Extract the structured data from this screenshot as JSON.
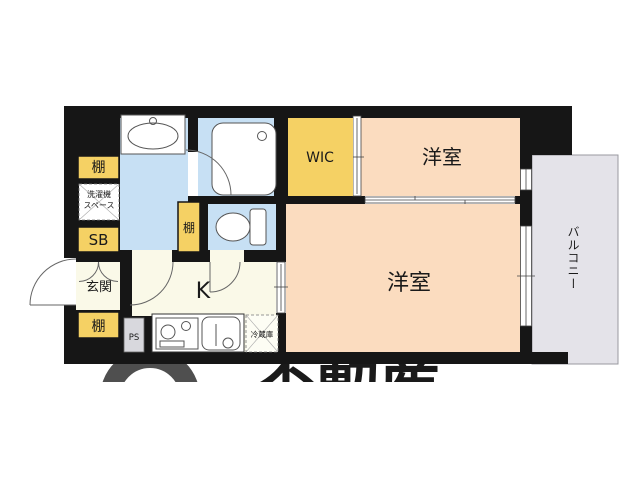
{
  "plan": {
    "rooms": {
      "western_top": "洋室",
      "western_main": "洋室",
      "kitchen": "K",
      "entrance": "玄関",
      "wic": "WIC"
    },
    "fixtures": {
      "shelf": "棚",
      "shoe_box": "SB",
      "pipe_space": "PS",
      "refrigerator": "冷蔵庫",
      "washer_space_line1": "洗濯機",
      "washer_space_line2": "スペース"
    },
    "balcony_label": "バルコニー",
    "watermark_text": "不動産"
  },
  "colors": {
    "wall": "#161616",
    "room_peach": "#FBDCBF",
    "closet_yellow": "#F5D164",
    "water_blue": "#C7E0F4",
    "kitchen_cream": "#FAF9E8",
    "balcony_gray": "#E4E3E9",
    "watermark_gray": "#4F4F4F",
    "line": "#555555"
  }
}
